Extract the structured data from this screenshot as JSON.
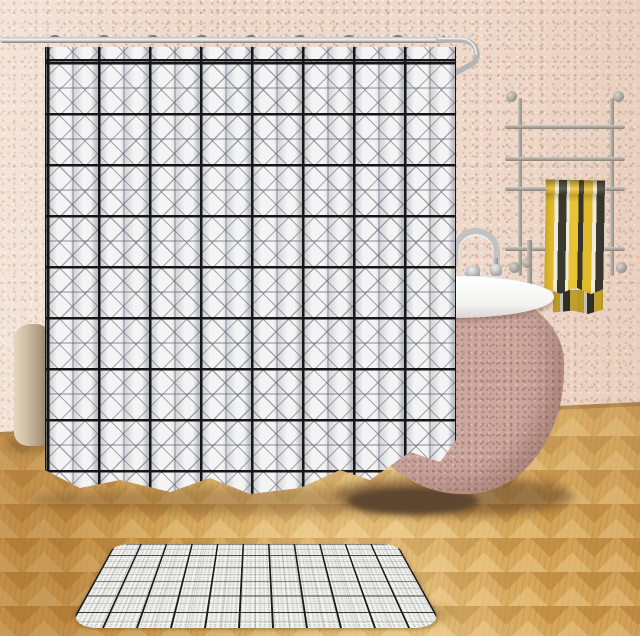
{
  "image_type": "product-photo",
  "scene": {
    "setting": "bathroom",
    "subject": "Black-and-white geometric grid shower curtain with matching bath mat",
    "visible_text": ""
  },
  "objects": {
    "wall": {
      "label": "pink speckled bathroom wall",
      "color": "#eedacd"
    },
    "floor": {
      "label": "herringbone wood floor",
      "color": "#d7a95c"
    },
    "curtain_rod": {
      "label": "chrome shower curtain rod with curved end",
      "color": "#c9c9c9"
    },
    "curtain_hooks": {
      "label": "curtain rings on rod",
      "count": 9,
      "color": "#7d7d7d"
    },
    "shower_curtain": {
      "label": "white shower curtain with black grid and gray X diamond pattern",
      "base_color": "#f4f4f5",
      "grid_color": "#161616",
      "accent_color": "#8a8a94"
    },
    "towel_rack": {
      "label": "wall-mounted ladder towel rack",
      "bars": 4,
      "color": "#a9a49c"
    },
    "towel": {
      "label": "vertically striped towel",
      "stripe_colors": [
        "#e2bb2b",
        "#f0ecdc",
        "#3a392f"
      ]
    },
    "bathtub": {
      "label": "freestanding egg-shaped bathtub",
      "body_color": "#cba79e",
      "rim_color": "#fbfbfb"
    },
    "faucet": {
      "label": "chrome gooseneck tub faucet",
      "color": "#c2c2c2"
    },
    "plant": {
      "label": "green palm plant",
      "color": "#4f7f33"
    },
    "vase": {
      "label": "tall beige floor vase",
      "color": "#c3b094"
    },
    "bath_mat": {
      "label": "matching grid bath mat on floor",
      "base_color": "#f1f1ef",
      "grid_color": "#1b1b1b"
    }
  }
}
